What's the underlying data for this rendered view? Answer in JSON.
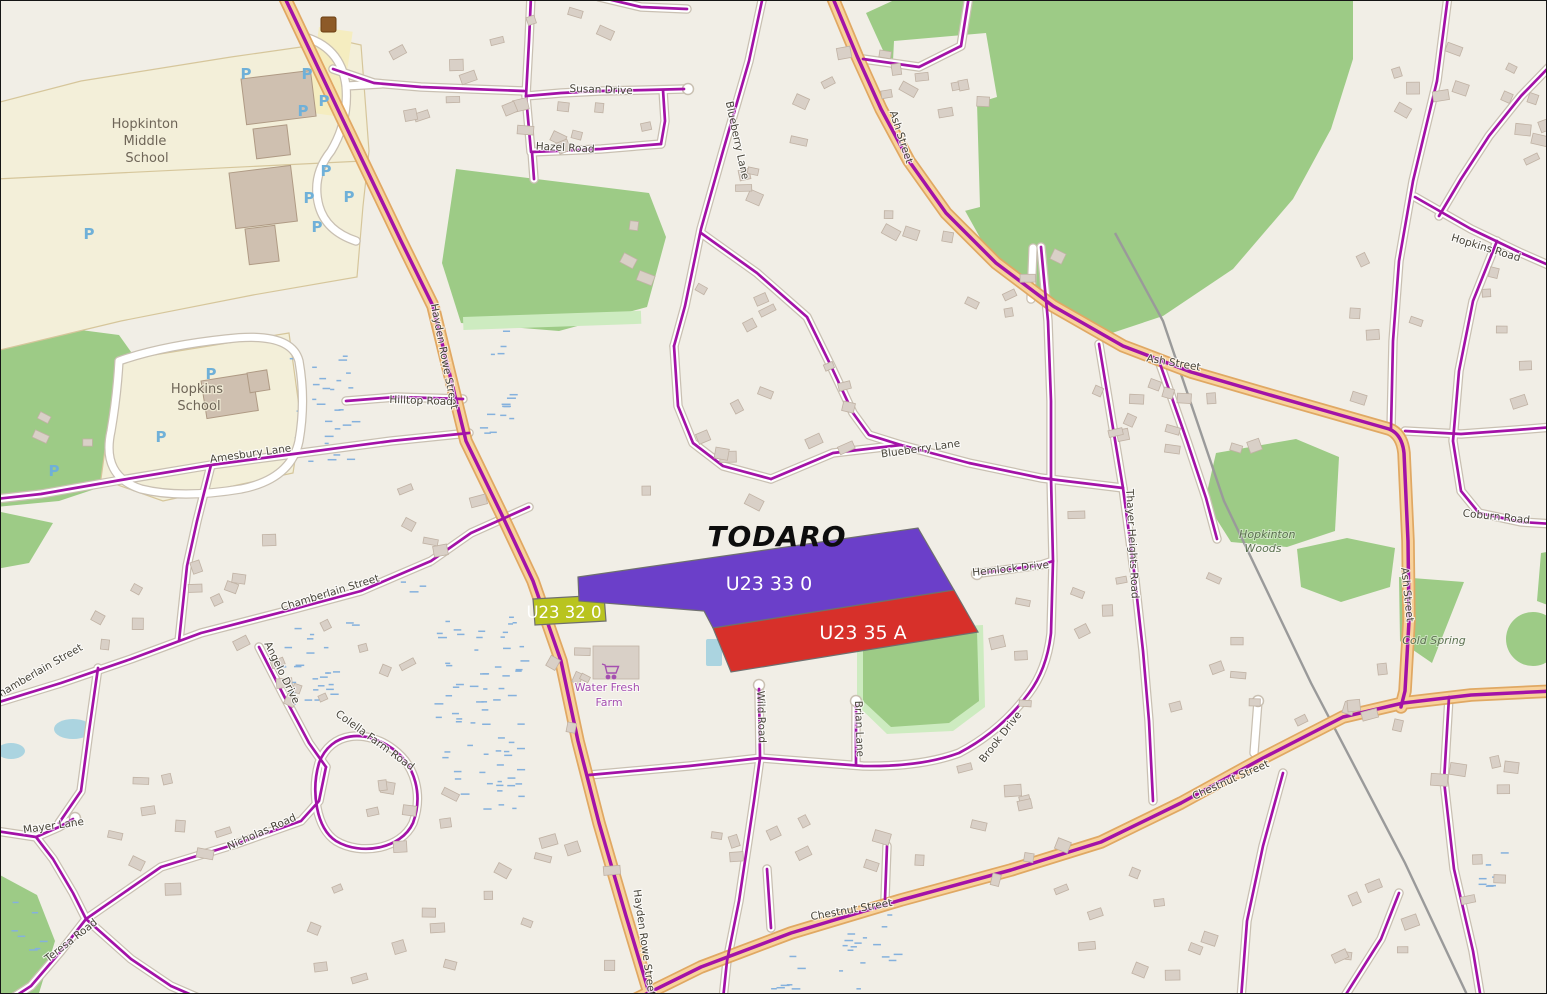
{
  "colors": {
    "parcel_purple": "#6b3fc9",
    "parcel_red": "#d7302a",
    "parcel_olive": "#b9c41f",
    "overlay_purple": "#a312a7",
    "major_road": "#f8d29c",
    "forest": "#9dcb86",
    "water": "#abd4e0",
    "farm_purple": "#a54fb0"
  },
  "highlight": {
    "owner": "TODARO",
    "parcels": [
      {
        "id": "U23 33 0"
      },
      {
        "id": "U23 35 A"
      },
      {
        "id": "U23 32 0"
      }
    ]
  },
  "places": {
    "middle_school_line1": "Hopkinton",
    "middle_school_line2": "Middle",
    "middle_school_line3": "School",
    "hopkins_school_line1": "Hopkins",
    "hopkins_school_line2": "School",
    "farm_line1": "Water Fresh",
    "farm_line2": "Farm",
    "woods_line1": "Hopkinton",
    "woods_line2": "Woods",
    "cold_spring": "Cold Spring",
    "parking": "P"
  },
  "streets": {
    "susan_drive": "Susan Drive",
    "hazel_road": "Hazel Road",
    "blueberry_lane": "Blueberry Lane",
    "ash_street": "Ash Street",
    "hayden_rowe": "Hayden Rowe Street",
    "hilltop_road": "Hilltop Road",
    "amesbury_lane": "Amesbury Lane",
    "chamberlain_street": "Chamberlain Street",
    "angelo_drive": "Angelo Drive",
    "colella_farm_road": "Colella Farm Road",
    "mayer_lane": "Mayer Lane",
    "nicholas_road": "Nicholas Road",
    "teresa_road": "Teresa Road",
    "wild_road": "Wild Road",
    "brian_lane": "Brian Lane",
    "brook_drive": "Brook Drive",
    "hemlock_drive": "Hemlock Drive",
    "thayer_heights": "Thayer Heights Road",
    "chestnut_street": "Chestnut Street",
    "hopkins_road": "Hopkins Road",
    "coburn_road": "Coburn Road"
  }
}
